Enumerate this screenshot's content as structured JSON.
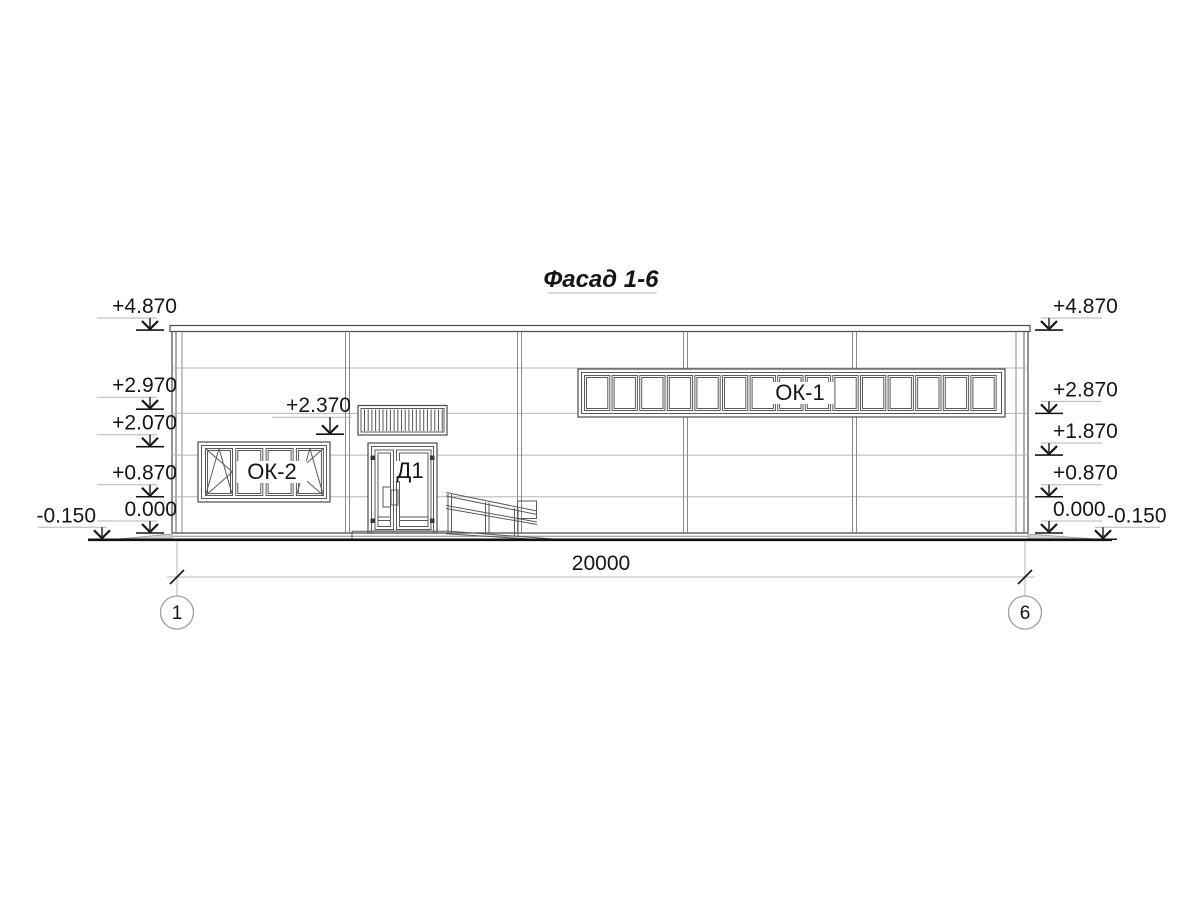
{
  "title": "Фасад 1-6",
  "labels": {
    "window_band": "ОК-1",
    "window_left": "ОК-2",
    "door": "Д1"
  },
  "dimension": {
    "total": "20000"
  },
  "axes": [
    {
      "id": "1"
    },
    {
      "id": "6"
    }
  ],
  "elevation_marks": {
    "left": [
      {
        "label": "+4.870",
        "level": 4.87
      },
      {
        "label": "+2.970",
        "level": 2.97
      },
      {
        "label": "+2.070",
        "level": 2.07
      },
      {
        "label": "+0.870",
        "level": 0.87
      },
      {
        "label": "0.000",
        "level": 0.0
      },
      {
        "label": "-0.150",
        "level": -0.15
      }
    ],
    "right": [
      {
        "label": "+4.870",
        "level": 4.87
      },
      {
        "label": "+2.870",
        "level": 2.87
      },
      {
        "label": "+1.870",
        "level": 1.87
      },
      {
        "label": "+0.870",
        "level": 0.87
      },
      {
        "label": "0.000",
        "level": 0.0
      },
      {
        "label": "-0.150",
        "level": -0.15
      }
    ],
    "canopy": {
      "label": "+2.370",
      "level": 2.37
    }
  },
  "colors": {
    "ink": "#151515",
    "outline": "#4a4a4a",
    "medium": "#8b8b8b",
    "light": "#b5b5b5"
  }
}
